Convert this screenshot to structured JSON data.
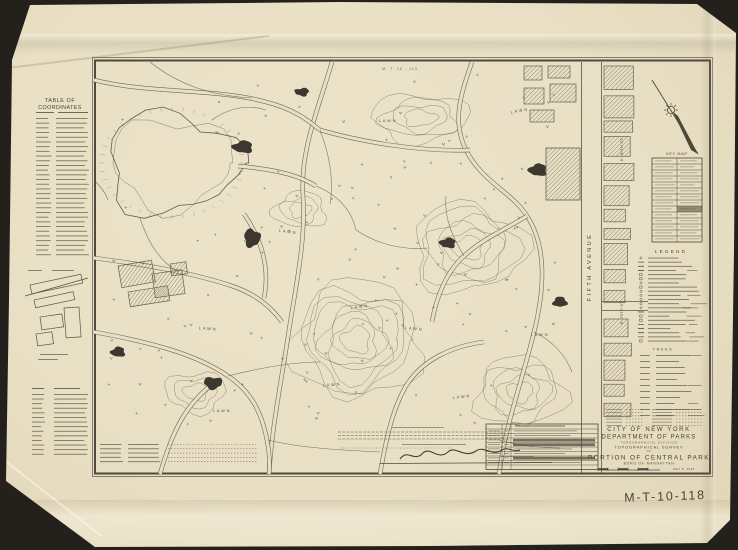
{
  "document": {
    "sheet_number": "M-T-10-118",
    "top_margin_ref": "M. T. 10 - 113",
    "coordinates_table": {
      "title_line1": "TABLE OF",
      "title_line2": "COORDINATES"
    },
    "key_map": {
      "title": "KEY MAP"
    },
    "legend": {
      "title": "LEGEND",
      "trees_heading": "TREES"
    },
    "map_labels": {
      "avenue": "FIFTH AVENUE",
      "street_80": "E. 80TH ST.",
      "street_79": "E. 79TH ST.",
      "lawn": "LAWN"
    },
    "title_block": {
      "agency_line1": "CITY OF NEW YORK",
      "agency_line2": "DEPARTMENT OF PARKS",
      "division": "TOPOGRAPHICAL DIVISION",
      "survey": "TOPOGRAPHICAL SURVEY",
      "of": "OF",
      "title": "PORTION OF CENTRAL PARK",
      "boro": "BORO OF MANHATTAN",
      "date": "MAY 8, 1935"
    },
    "colors": {
      "background": "#24211c",
      "paper": "#e9dfc4",
      "ink": "#5a5347"
    }
  }
}
